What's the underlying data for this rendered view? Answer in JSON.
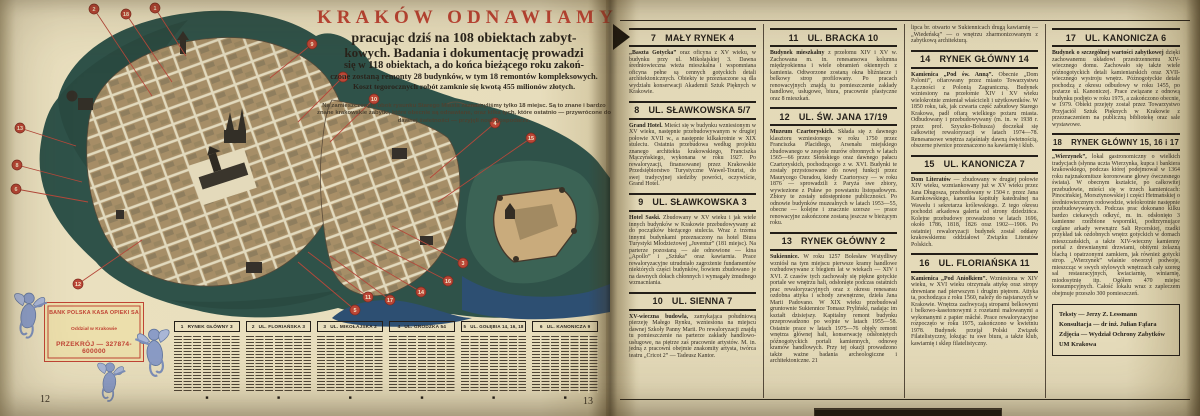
{
  "left_page": {
    "page_number": "12",
    "facing_page_number": "13",
    "header": {
      "title": "KRAKÓW ODNAWIAMY",
      "lines": [
        "pracując dziś na 108 obiektach zabyt-",
        "kowych. Badania i dokumentację prowadzi",
        "się w 118 obiektach, a do końca bieżącego roku zakoń-",
        "czone zostaną remonty 28 budynków, w tym 18 remontów kompleksowych.",
        "Koszt tegorocznych robót zamknie się kwotą 455 milionów złotych."
      ],
      "note": "Na zamieszczonym obok rysunku Starego Miasta zaznaczyliśmy tylko 18 miejsc. Są to znane i bardzo znane krakowskie zabytki, które obecnie są odnawiane, oraz kilka tych, które ostatnio — przywrócone do dawnej świetności — przyjęli nowi gospodarze."
    },
    "stamp": {
      "line1": "BANK POLSKA KASA OPIEKI SA",
      "line2": "Oddział w Krakowie",
      "line3": "PRZEKRÓJ — 327874-600000"
    },
    "map_markers": [
      {
        "n": "2",
        "x": 94,
        "y": 9,
        "tx": 152,
        "ty": 96
      },
      {
        "n": "18",
        "x": 126,
        "y": 14,
        "tx": 172,
        "ty": 82
      },
      {
        "n": "1",
        "x": 155,
        "y": 8,
        "tx": 186,
        "ty": 56
      },
      {
        "n": "9",
        "x": 312,
        "y": 44,
        "tx": 270,
        "ty": 78
      },
      {
        "n": "7",
        "x": 343,
        "y": 77,
        "tx": 298,
        "ty": 122
      },
      {
        "n": "10",
        "x": 374,
        "y": 99,
        "tx": 330,
        "ty": 142
      },
      {
        "n": "4",
        "x": 495,
        "y": 123,
        "tx": 430,
        "ty": 178
      },
      {
        "n": "15",
        "x": 531,
        "y": 138,
        "tx": 438,
        "ty": 202
      },
      {
        "n": "13",
        "x": 20,
        "y": 128,
        "tx": 76,
        "ty": 146
      },
      {
        "n": "8",
        "x": 17,
        "y": 165,
        "tx": 82,
        "ty": 182
      },
      {
        "n": "6",
        "x": 16,
        "y": 189,
        "tx": 88,
        "ty": 202
      },
      {
        "n": "12",
        "x": 78,
        "y": 284,
        "tx": 142,
        "ty": 240
      },
      {
        "n": "5",
        "x": 355,
        "y": 310,
        "tx": 298,
        "ty": 262
      },
      {
        "n": "11",
        "x": 368,
        "y": 297,
        "tx": 308,
        "ty": 252
      },
      {
        "n": "17",
        "x": 390,
        "y": 300,
        "tx": 330,
        "ty": 256
      },
      {
        "n": "14",
        "x": 421,
        "y": 292,
        "tx": 350,
        "ty": 250
      },
      {
        "n": "16",
        "x": 448,
        "y": 281,
        "tx": 372,
        "ty": 242
      },
      {
        "n": "3",
        "x": 463,
        "y": 263,
        "tx": 392,
        "ty": 226
      }
    ],
    "mini_columns": [
      {
        "num": "1",
        "title": "RYNEK GŁÓWNY 3"
      },
      {
        "num": "2",
        "title": "UL. FLORIAŃSKA 3"
      },
      {
        "num": "3",
        "title": "UL. MIKOŁAJSKA 2"
      },
      {
        "num": "4",
        "title": "UL. GRODZKA 54"
      },
      {
        "num": "5",
        "title": "UL. GOŁĘBIA 14, 16, 18"
      },
      {
        "num": "6",
        "title": "UL. KANONICZA 9"
      }
    ],
    "end_mark": "■"
  },
  "right_page": {
    "entries": {
      "e7": {
        "num": "7",
        "street": "MAŁY RYNEK 4",
        "lead": "„Baszta Gotycka”",
        "body": " oraz oficyna z XV wieku, w budynku przy ul. Mikołajskiej 3. Dawna średniowieczna wieża mieszkalna i wspomniana oficyna pełne są cennych gotyckich detali architektonicznych. Obiekty te przeznaczone są dla wydziału konserwacji Akademii Sztuk Pięknych w Krakowie."
      },
      "e8": {
        "num": "8",
        "street": "UL. SŁAWKOWSKA 5/7",
        "lead": "Grand Hotel.",
        "body": " Mieści się w budynku wzniesionym w XV wieku, następnie przebudowywanym w drugiej połowie XVII w., a następnie kilkakrotnie w XIX stuleciu. Ostatnia przebudowa według projektu znanego architekta krakowskiego, Franciszka Mączyńskiego, wykonana w roku 1927. Po rewaloryzacji, finansowanej przez Krakowskie Przedsiębiorstwo Turystyczne Wawel-Tourist, do swej tradycyjnej siedziby powróci, oczywiście, Grand Hotel."
      },
      "e9": {
        "num": "9",
        "street": "UL. SŁAWKOWSKA 3",
        "lead": "Hotel Saski.",
        "body": " Zbudowany w XV wieku i jak wiele innych budynków w Krakowie przebudowywany aż do początków bieżącego stulecia. Wraz z trzema innymi budynkami przeznaczony na hotel Biura Turystyki Młodzieżowej „Juventur” (181 miejsc). Na parterze pozostaną — ale odnowione — kina „Apollo” i „Sztuka” oraz kawiarnia. Prace rewaloryzacyjne utrudniało zagrożenie fundamentów niektórych części budynków, bowiem zbudowano je na dawnych dołach chłonnych i wymagały żmudnego wzmacniania."
      },
      "e10": {
        "num": "10",
        "street": "UL. SIENNA 7",
        "lead": "XV-wieczna budowla,",
        "body": " zamykająca południową pierzeję Małego Rynku, wzniesiona na miejscu dawnej Szkoły Panny Marii. Po rewaloryzacji znajdą tu pomieszczenie na parterze zakłady handlowo-usługowe, na piętrze zaś pracownie artystów. M. in. jedną z pracowni obejmie znakomity artysta, twórca teatru „Cricot 2” — Tadeusz Kantor."
      },
      "e11": {
        "num": "11",
        "street": "UL. BRACKA 10",
        "lead": "Budynek mieszkalny",
        "body": " z przełomu XIV i XV w. Zachowana m. in. renesansowa kolumna międzyokienna i wiele obramień okiennych z kamienia. Odtworzone zostaną okna bliźniacze i belkowy strop profilowany. Po pracach renowacyjnych znajdą tu pomieszczenie zakłady handlowe, usługowe, biura, pracownie plastyczne oraz 8 mieszkań."
      },
      "e12": {
        "num": "12",
        "street": "UL. ŚW. JANA 17/19",
        "lead": "Muzeum Czartoryskich.",
        "body": " Składa się z dawnego klasztoru wzniesionego w roku 1750 przez Franciszka Placidiego, Arsenału miejskiego zbudowanego w zespole murów obronnych w latach 1565—66 przez Słońskiego oraz dawnego pałacu Czartoryskich, pochodzącego z w. XVI. Budynki te zostały przystosowane do nowej funkcji przez Maurycego Ouradou, kiedy Czartoryscy — w roku 1876 — sprowadzili z Paryża swe zbiory, wywiezione z Puław po powstaniu listopadowym. Zbiory te zostały udostępnione publiczności. Po odnowie budynków muzealnych w latach 1953—55, obecne — kolejne i znacznie szersze — prace renowacyjne zakończone zostaną jeszcze w bieżącym roku."
      },
      "e13": {
        "num": "13",
        "street": "RYNEK GŁÓWNY 2",
        "lead": "Sukiennice.",
        "body": " W roku 1257 Bolesław Wstydliwy wzniósł na tym miejscu pierwsze kramy handlowe rozbudowywane z biegiem lat w wiekach — XIV i XVI. Z czasów tych zachowały się piękne gotyckie portale we wnętrzu hali, odsłonięte podczas ostatnich prac rewaloryzacyjnych oraz z okresu renesansu ozdobna attyka i schody zewnętrzne, dzieła Jana Marii Padovano. W XIX wieku przebudował gruntownie Sukiennice Tomasz Pryliński, nadając im kształt dzisiejszy. Kapitalny remont budynku przeprowadzono po wojnie w latach 1955—58. Ostatnie prace w latach 1975—76 objęły remont wnętrza głównej hali, konserwację odsłoniętych późnogotyckich portali kamiennych, odnowę kramów handlowych. Przy tej okazji prowadzono także ważne badania archeologiczne i architektoniczne. 21"
      },
      "e14": {
        "num": "14",
        "street": "RYNEK GŁÓWNY 14",
        "lead": "Kamienica „Pod św. Anną”.",
        "body": " Obecnie „Dom Polonii”, ofiarowany przez miasto Towarzystwu Łączności z Polonią Zagraniczną. Budynek wzniesiony na przełomie XIV i XV wieku wielokrotnie zmieniał właścicieli i użytkowników. W 1850 roku, tak, jak czwarta część zabudowy Starego Krakowa, padł ofiarą wielkiego pożaru miasta. Odbudowany i przebudowywany (m. in. w 1938 r. przez prof. Szyszko-Bohusza) doczekał się całkowitej rewaloryzacji w latach 1974—78. Renesansowe wnętrza zajaśniały dawną świetnością, obszerne piwnice przeznaczono na kawiarnię i klub."
      },
      "e15": {
        "num": "15",
        "street": "UL. KANONICZA 7",
        "lead": "Dom Literatów",
        "body": " — zbudowany w drugiej połowie XIV wieku, wzmiankowany już w XV wieku przez Jana Długosza, przebudowany w 1504 r. przez Jana Karnkowskiego, kanonika kapituły katedralnej na Wawelu i sekretarza królewskiego. Z tego okresu pochodzi arkadowa galeria od strony dziedzińca. Kolejne przebudowy prowadzono w latach 1696, około 1786, 1818, 1826 oraz 1902—1906. Po ostatniej rewaloryzacji budynek został oddany krakowskiemu oddziałowi Związku Literatów Polskich."
      },
      "e16": {
        "num": "16",
        "street": "UL. FLORIAŃSKA 11",
        "lead": "Kamienica „Pod Aniołkiem”.",
        "body": " Wzniesiona w XIV wieku, w XVI wieku otrzymała attykę oraz stropy drewniane nad pierwszym i drugim piętrem. Attyka ta, pochodząca z roku 1560, należy do najstarszych w Krakowie. Wnętrza zachwycają stropami belkowymi i belkowo-kasetonowymi z rozetami malowanymi a wykonanymi z papier mâché. Prace rewaloryzacyjne rozpoczęto w roku 1975, zakończono w kwietniu 1978. Budynek przejął Polski Związek Filatelistyczny, lokując tu swe biura, a także klub, kawiarnię i sklep filatelistyczny."
      },
      "e17": {
        "num": "17",
        "street": "UL. KANONICZA 6",
        "lead": "Budynek o szczególnej wartości zabytkowej",
        "body": " dzięki zachowanemu układowi przestrzennemu XIV-wiecznego domu. Zachowało się także wiele późnogotyckich detali kamieniarskich oraz XVII-wiecznego wystroju wnętrz. Późnogotyckie detale pochodzą z okresu odbudowy w roku 1455, po pożarze ul. Kanoniczej. Prace związane z odnową budynku podjęto w roku 1975, a zakończono obecnie, w 1979. Obiekt przejęty został przez Towarzystwo Przyjaciół Sztuk Pięknych w Krakowie z przeznaczeniem na publiczną bibliotekę oraz sale wystawowe."
      },
      "e18": {
        "num": "18",
        "street": "RYNEK GŁÓWNY 15, 16 i 17",
        "lead": "„Wierzynek”,",
        "body": " lokal gastronomiczny o wielkich tradycjach (słynna uczta Wierzynka, kupca i bankiera krakowskiego, podczas której podejmował w 1364 roku najznakomitsze koronowane głowy ówczesnego świata). W obecnym kształcie, po całkowitej przebudowie, mieści się w trzech kamienicach: Pinocińskiej, Morsztynowskiej i części Hetmańskiej o średniowiecznym rodowodzie, wielokrotnie następnie przebudowywanych. Podczas prac dokonano kilku bardzo ciekawych odkryć, m. in. odsłonięto 3 kamienne rzeźbione wsporniki, podtrzymujące ceglane arkady wewnątrz Sali Rycerskiej, rzadki przykład tak ozdobnych wnętrz gotyckich w domach mieszczańskich, a także XIV-wieczny kamienny portal z drewnianymi drzwiami, obitymi żelazną blachą i opatrzonymi zamkiem, jak również gotycki strop. „Wierzynek” właśnie otworzył podwoje, mieszcząc w swych stylowych wnętrzach cały szereg sal restauracyjnych, kwiaciarnię, winiarnię, miodosytnię itp. Ogółem 470 miejsc konsumpcyjnych. Całość lokalu wraz z zapleczem obejmuje przeszło 300 pomieszczeń."
      }
    },
    "columns": [
      {
        "entries": [
          "e7",
          "e8",
          "e9",
          "e10"
        ]
      },
      {
        "entries": [
          "e11",
          "e12",
          "e13"
        ]
      },
      {
        "cont": "lipca br. otwarto w Sukiennicach drugą kawiarnię — „Wiedeńską” — o wnętrzu zharmonizowanym z zabytkową architekturą.",
        "entries": [
          "e14",
          "e15",
          "e16"
        ]
      },
      {
        "entries": [
          "e17",
          "e18"
        ],
        "credits": [
          "Teksty — Jerzy Z. Lessmann",
          "Konsultacja — dr inż. Julian Fąfara",
          "Zdjęcia — Wydział Ochrony Zabytków UM Krakowa"
        ]
      }
    ]
  },
  "colors": {
    "title_red": "#bf4434",
    "ink": "#241f19",
    "paper": "#e7ddbc",
    "park_green": "#2f5249",
    "city_tan": "#b69c74",
    "river_blue": "#2d4f72",
    "marker_red": "#bb4636",
    "stamp_red": "#c04435",
    "cherub_blue": "#8b9cc6"
  }
}
